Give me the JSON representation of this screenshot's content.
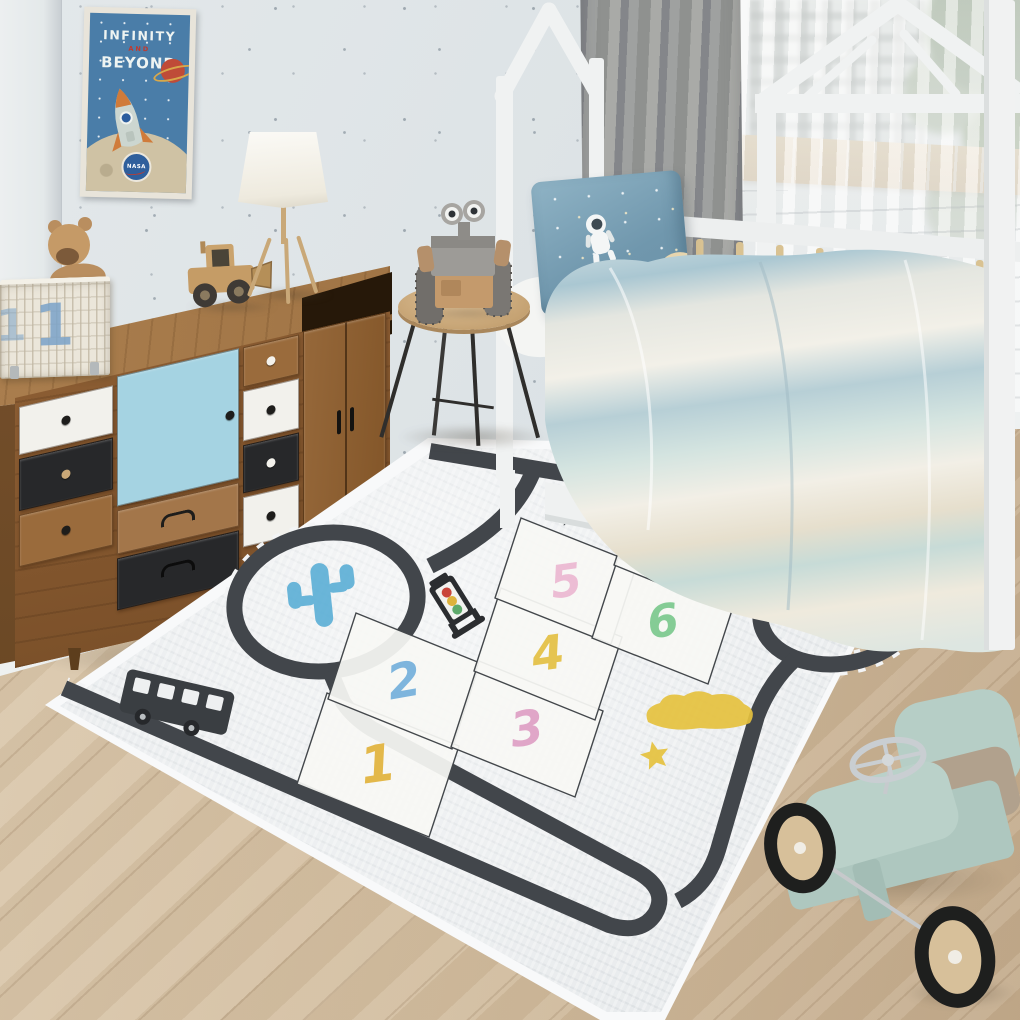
{
  "room": {
    "type": "children-bedroom-photo"
  },
  "palette": {
    "wall": "#dfe4e7",
    "floor_wood": "#d8c5aa",
    "rug_base": "#e7eaec",
    "rug_edge": "#f8f9fa",
    "road": "#42464b",
    "road_dash": "#f3f4f5",
    "dresser_wood": "#8a5c32",
    "drawer_blue": "#a5d3e2",
    "drawer_black": "#27282a",
    "drawer_white": "#f2f1ec",
    "bed_white": "#f0f2f2",
    "pillow_blue": "#7fa6bb",
    "toy_car_mint": "#b6cec6",
    "cactus_blue": "#57add5",
    "traffic_red": "#c9453a",
    "traffic_yellow": "#ddb23c",
    "traffic_green": "#5ea96a"
  },
  "poster": {
    "title_line1": "INFINITY",
    "title_line2": "AND",
    "title_line3": "BEYOND",
    "logo_text": "NASA"
  },
  "storage_basket": {
    "number": "1"
  },
  "rug": {
    "hopscotch_tiles": [
      {
        "number": "1",
        "x": 378,
        "y": 765,
        "s": 1.06,
        "color": "#e2b33c",
        "rot": -8
      },
      {
        "number": "2",
        "x": 404,
        "y": 681,
        "s": 1.0,
        "color": "#74b0dc",
        "rot": -10
      },
      {
        "number": "3",
        "x": 527,
        "y": 729,
        "s": 1.0,
        "color": "#dfa0c5",
        "rot": -8
      },
      {
        "number": "4",
        "x": 548,
        "y": 654,
        "s": 0.97,
        "color": "#e4c044",
        "rot": -8
      },
      {
        "number": "5",
        "x": 566,
        "y": 581,
        "s": 0.93,
        "color": "#ecb8d2",
        "rot": -8
      },
      {
        "number": "6",
        "x": 663,
        "y": 621,
        "s": 0.93,
        "color": "#7cc98e",
        "rot": -8
      },
      {
        "number": "7",
        "x": 682,
        "y": 549,
        "s": 0.9,
        "color": "#edb445",
        "rot": -8
      }
    ],
    "decor": [
      {
        "type": "planet",
        "x": 636,
        "y": 489,
        "s": 1,
        "color": "#e9c648"
      },
      {
        "type": "star",
        "x": 611,
        "y": 511,
        "s": 11,
        "color": "#e9c648"
      },
      {
        "type": "star",
        "x": 569,
        "y": 514,
        "s": 13,
        "color": "#3f4347"
      },
      {
        "type": "cloud",
        "x": 700,
        "y": 714,
        "s": 1,
        "color": "#e5c13e"
      },
      {
        "type": "star",
        "x": 655,
        "y": 756,
        "s": 15,
        "color": "#e5c13e"
      },
      {
        "type": "cactus",
        "x": 322,
        "y": 597,
        "s": 1,
        "color": "#57add5"
      },
      {
        "type": "cactus",
        "x": 838,
        "y": 599,
        "s": 0.55,
        "color": "#57add5"
      },
      {
        "type": "traffic_light",
        "x": 452,
        "y": 601,
        "s": 1,
        "color": "#2b2d30"
      },
      {
        "type": "traffic_light",
        "x": 846,
        "y": 540,
        "s": 0.8,
        "color": "#2b2d30"
      },
      {
        "type": "car",
        "x": 812,
        "y": 514,
        "s": 1,
        "color": "#34383c"
      },
      {
        "type": "bus",
        "x": 176,
        "y": 706,
        "s": 1,
        "color": "#3a3e42"
      }
    ]
  }
}
